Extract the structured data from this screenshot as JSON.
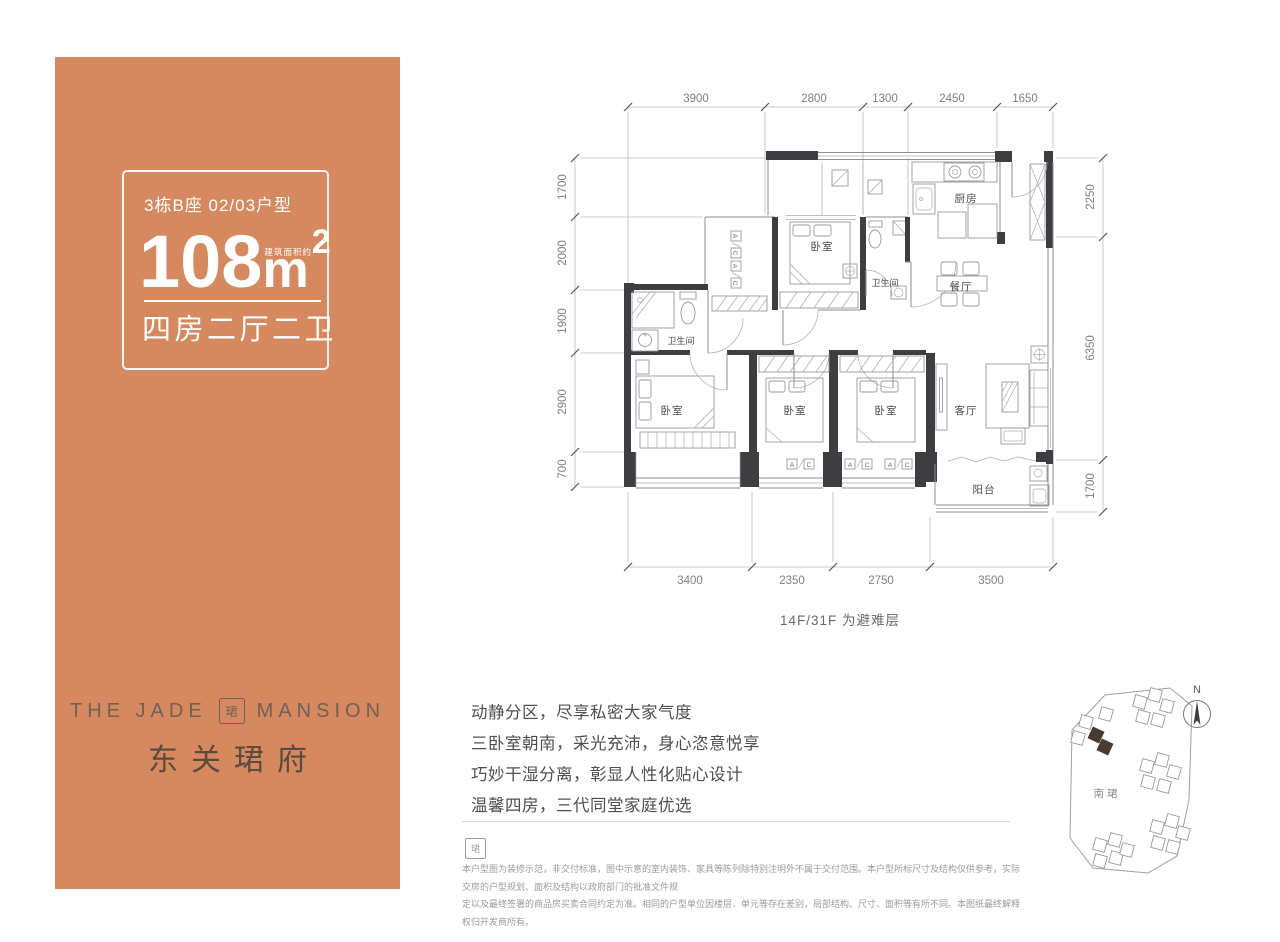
{
  "brand_panel": {
    "bg_color": "#D6895F",
    "unit_label": "3栋B座 02/03户型",
    "area_note": "建筑面积约",
    "area_value": "108",
    "area_unit": "m",
    "area_sup": "2",
    "layout_label": "四房二厅二卫",
    "logo_en_left": "THE JADE",
    "logo_en_right": "MANSION",
    "logo_seal": "珺",
    "logo_cn": "东关珺府"
  },
  "plan": {
    "note": "14F/31F 为避难层",
    "dims": {
      "top": [
        "3900",
        "2800",
        "1300",
        "2450",
        "1650"
      ],
      "bottom": [
        "3400",
        "2350",
        "2750",
        "3500"
      ],
      "left": [
        "1700",
        "2000",
        "1900",
        "2900",
        "700"
      ],
      "right": [
        "2250",
        "6350",
        "1700"
      ]
    },
    "rooms": {
      "kitchen": "厨房",
      "bedroom": "卧室",
      "bath": "卫生间",
      "dining": "餐厅",
      "living": "客厅",
      "balcony": "阳台"
    },
    "labels": {
      "ac_a": "A",
      "ac_c": "C"
    }
  },
  "highlights": [
    "动静分区，尽享私密大家气度",
    "三卧室朝南，采光充沛，身心恣意悦享",
    "巧妙干湿分离，彰显人性化贴心设计",
    "温馨四房，三代同堂家庭优选"
  ],
  "footer": {
    "seal": "珺",
    "disclaimer_line1": "本户型图为装修示范，非交付标准，图中示意的室内装饰、家具等陈列除特别注明外不属于交付范围。本户型所标尺寸及结构仅供参考，实际交房的户型规划、面积及结构以政府部门的批准文件规",
    "disclaimer_line2": "定以及最终签署的商品房买卖合同约定为准。相同的户型单位因楼层、单元等存在差别，局部结构、尺寸、面积等有所不同。本图纸最终解释权归开发商所有。"
  },
  "sitemap": {
    "project_label": "南珺",
    "north_label": "N"
  }
}
